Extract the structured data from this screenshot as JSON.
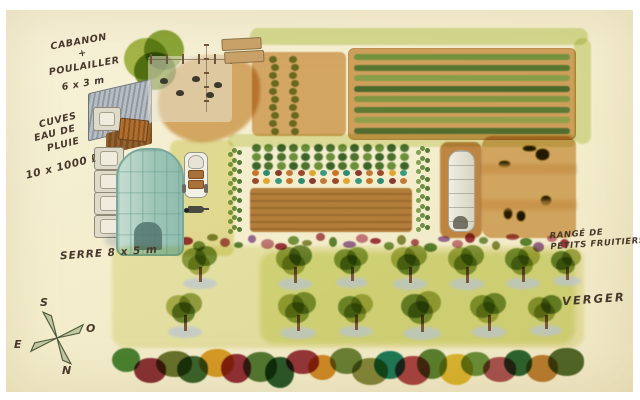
{
  "labels": {
    "cabanon": {
      "line1": "CABANON",
      "line2": "+",
      "line3": "POULAILLER",
      "line4": "6 x 3 m"
    },
    "cuves": {
      "line1": "CUVES",
      "line2": "EAU DE",
      "line3": "PLUIE",
      "quantity": "10 x 1000 ℓ"
    },
    "serre": "SERRE 8 x 5 m",
    "rangee": {
      "line1": "RANGÉ DE",
      "line2": "PETITS FRUITIERS"
    },
    "verger": "VERGER"
  },
  "compass": {
    "south": "S",
    "west": "O",
    "east": "E",
    "north": "N"
  },
  "palette": {
    "paper": "#f3edcc",
    "grass_path": "#dce5a8",
    "soil_tan": "#d8ab70",
    "tilled_brown": "#bb8747",
    "greenhouse_teal": "#9fc6b8",
    "tree_shadow_blue": "#b7c3d8",
    "ink": "#46382a"
  },
  "scene": {
    "crop_row_colors": [
      "#6f9b49",
      "#4e7a36",
      "#86a855",
      "#3f6b2f",
      "#7da04b",
      "#557f3a",
      "#90ab58",
      "#476f33"
    ],
    "seedling_color": "#7da04b",
    "seedling_columns": [
      {
        "x": 18,
        "count": 10
      },
      {
        "x": 38,
        "count": 10
      }
    ],
    "bush_colors": [
      "#4f7a38",
      "#6f9a46",
      "#3f6b30"
    ],
    "flower_colors": [
      "#c9742b",
      "#9c4a2e",
      "#2f8a74",
      "#e0a62e",
      "#8a3a2e",
      "#3a9a80",
      "#c27a3a"
    ],
    "fruit_row_colors": [
      "#c97f93",
      "#a43b49",
      "#7a9a4a",
      "#8a9148",
      "#b05a62",
      "#5f8a3a",
      "#9c6fae"
    ],
    "squash_colors": [
      "#b5c25a",
      "#cbd06a",
      "#e4c92f",
      "#9ab050",
      "#d9b93c"
    ],
    "hedge_colors": [
      "#4e8a3c",
      "#8e3640",
      "#6b7a36",
      "#3e6b35",
      "#e0a62e",
      "#993343",
      "#57813c",
      "#2e5f33",
      "#9c3a46",
      "#d9952f",
      "#6f8a3f",
      "#8a9148",
      "#21826b",
      "#b04a50",
      "#5f8a3a",
      "#e6c33c",
      "#6f9a44",
      "#b05a62",
      "#2f6b38",
      "#c2883a",
      "#556f31"
    ],
    "orchard": {
      "shadow_color": "#b7c3d8",
      "trunk_color": "#7a5638",
      "canopy_colors": [
        "#8fa84c",
        "#7a9a40",
        "#b4bd62",
        "#98ab50",
        "#6f8f3e",
        "#a8b45a",
        "#87a147"
      ],
      "rows": [
        {
          "y": 268,
          "ci": 0,
          "trees": [
            {
              "x": 200,
              "s": 44
            },
            {
              "x": 295,
              "s": 46
            },
            {
              "x": 352,
              "s": 42
            },
            {
              "x": 410,
              "s": 46
            },
            {
              "x": 467,
              "s": 46
            },
            {
              "x": 523,
              "s": 44
            },
            {
              "x": 567,
              "s": 38
            }
          ]
        },
        {
          "y": 316,
          "ci": 2,
          "trees": [
            {
              "x": 185,
              "s": 46
            },
            {
              "x": 298,
              "s": 48
            },
            {
              "x": 356,
              "s": 44
            },
            {
              "x": 422,
              "s": 50
            },
            {
              "x": 489,
              "s": 46
            },
            {
              "x": 546,
              "s": 42
            }
          ]
        }
      ]
    },
    "tanks": {
      "count": 4
    },
    "chickens": {
      "positions": [
        [
          12,
          22
        ],
        [
          28,
          34
        ],
        [
          44,
          20
        ],
        [
          58,
          36
        ],
        [
          66,
          26
        ]
      ]
    }
  }
}
